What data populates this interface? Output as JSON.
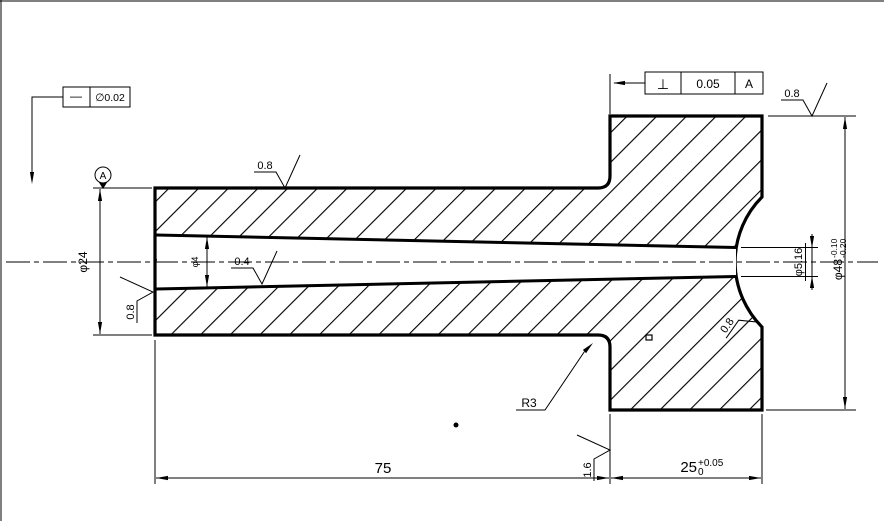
{
  "drawing": {
    "background": "#ffffff",
    "line_color": "#000000",
    "frames": {
      "straightness": {
        "symbol": "—",
        "tolerance": "∅0.02"
      },
      "perpendicularity": {
        "symbol": "⊥",
        "tolerance": "0.05",
        "datum": "A"
      }
    },
    "datum": {
      "label": "A"
    },
    "dims": {
      "shaft_od": "φ24",
      "head_od": "φ48",
      "head_od_upper": "-0.10",
      "head_od_lower": "-0.20",
      "bore_end": "φ5.16",
      "bore_start": "φ4",
      "len_shaft": "75",
      "len_head": "25",
      "len_head_upper": "+0.05",
      "len_head_lower": "0",
      "fillet": "R3"
    },
    "roughness": {
      "shaft_top": "0.8",
      "head_top": "0.8",
      "bore": "0.4",
      "bore_left": "0.8",
      "recess": "0.8",
      "step_face": "1.6"
    }
  }
}
